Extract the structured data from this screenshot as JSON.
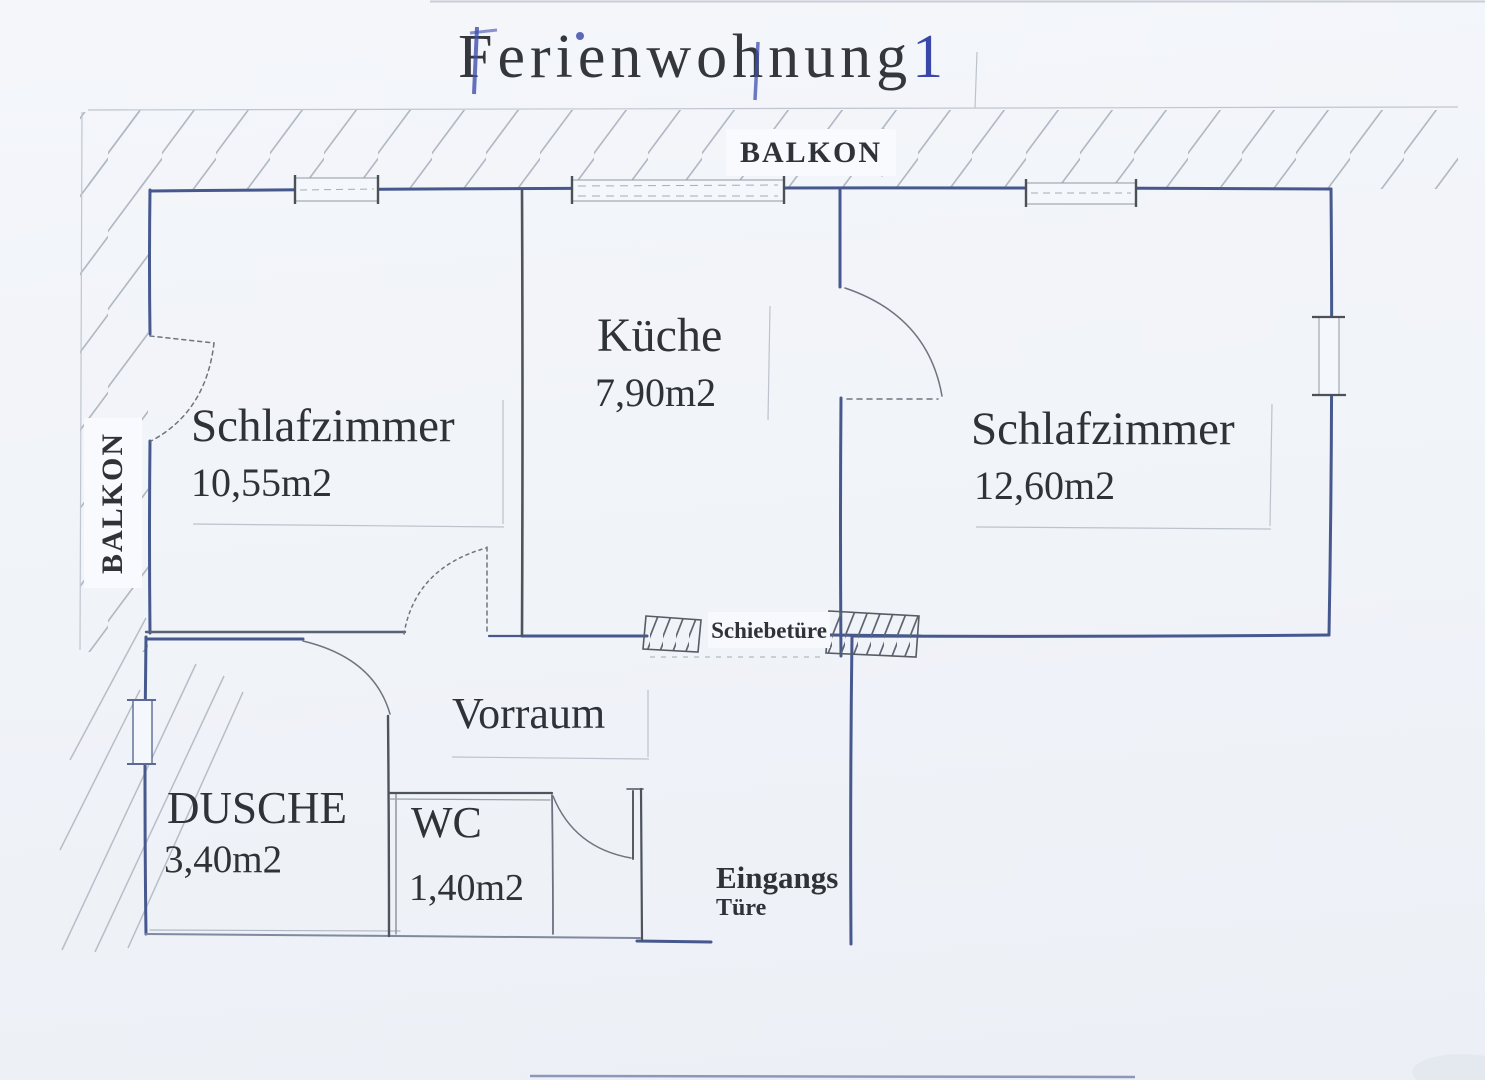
{
  "title": {
    "main": "Ferienwohnung",
    "number": "1"
  },
  "balcony": {
    "top_label": "BALKON",
    "left_label": "BALKON"
  },
  "rooms": {
    "bedroom_left": {
      "name": "Schlafzimmer",
      "area": "10,55m2"
    },
    "kitchen": {
      "name": "Küche",
      "area": "7,90m2"
    },
    "bedroom_right": {
      "name": "Schlafzimmer",
      "area": "12,60m2"
    },
    "hallway": {
      "name": "Vorraum"
    },
    "shower": {
      "name": "DUSCHE",
      "area": "3,40m2"
    },
    "wc": {
      "name": "WC",
      "area": "1,40m2"
    }
  },
  "doors": {
    "sliding_label": "Schiebetüre",
    "entrance_label_line1": "Eingangs",
    "entrance_label_line2": "Türe"
  },
  "colors": {
    "paper": "#f2f5f9",
    "wall_ink_blue": "#46588d",
    "pencil_dark": "#4e545e",
    "hatch_light": "#b0b8c4",
    "text_black": "#2f3237",
    "pen_blue": "#3847a8"
  }
}
